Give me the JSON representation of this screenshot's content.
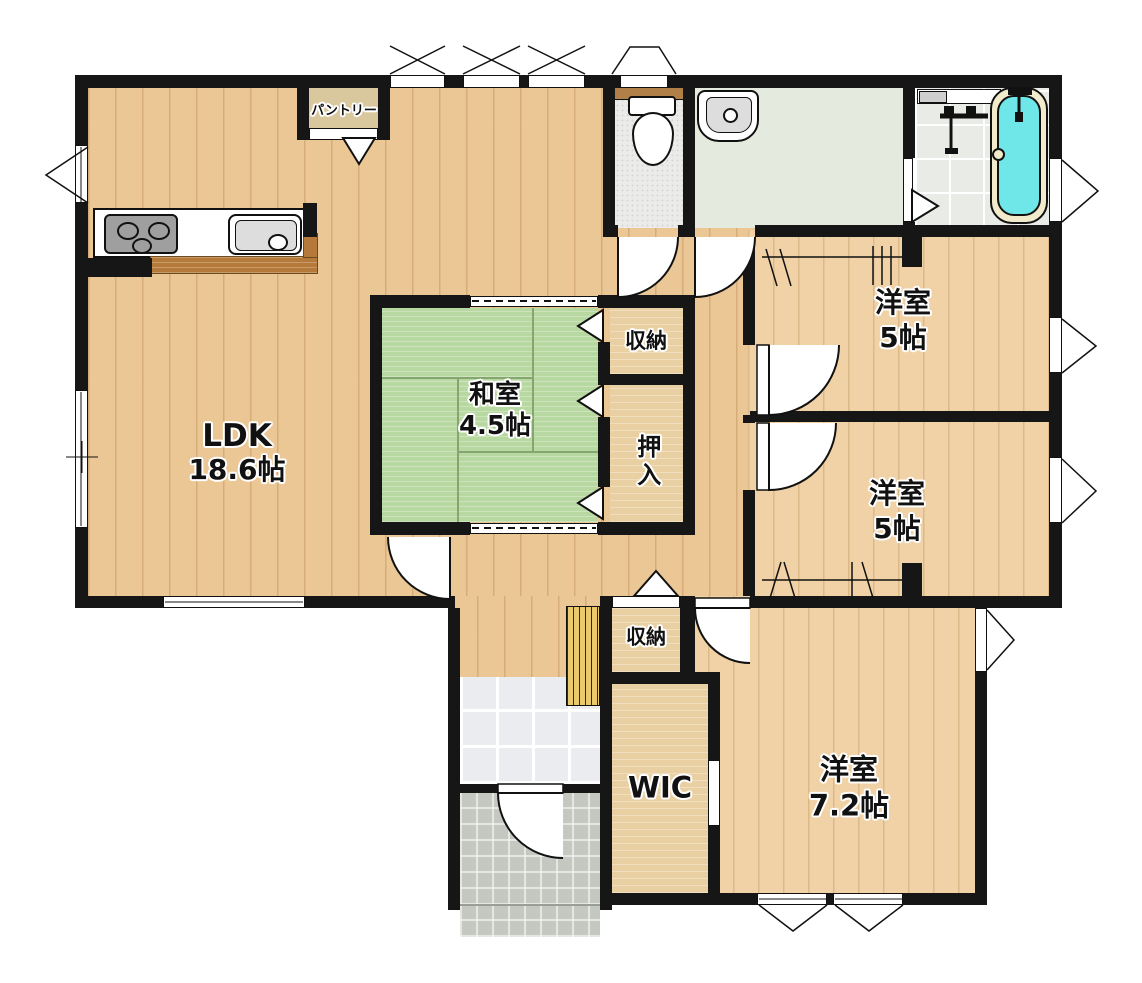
{
  "title": "floor-plan",
  "rooms": {
    "ldk": {
      "name": "LDK",
      "size": "18.6帖"
    },
    "washitsu": {
      "name": "和室",
      "size": "4.5帖"
    },
    "western_top": {
      "name": "洋室",
      "size": "5帖"
    },
    "western_mid": {
      "name": "洋室",
      "size": "5帖"
    },
    "western_7_2": {
      "name": "洋室",
      "size": "7.2帖"
    },
    "wic": {
      "name": "WIC"
    },
    "oshiire": {
      "name": "押入"
    },
    "storage_upper": {
      "name": "収納"
    },
    "storage_hall": {
      "name": "収納"
    },
    "pantry": {
      "name": "パントリー"
    }
  },
  "fixtures": {
    "stove": "gas-stove-3-burners",
    "sink": "kitchen-sink",
    "counter": "kitchen-counter",
    "toilet": "toilet",
    "washbasin": "washbasin",
    "bathtub": "bathtub",
    "shower": "shower-mixer",
    "shoe_rack": "shoe-cabinet-slats",
    "front_door": "entrance-door",
    "genkan": "entrance-tile",
    "porch": "porch-tile"
  },
  "colors": {
    "wall": "#161616",
    "wood_hall": "#ebc795",
    "wood_room": "#f0d2a6",
    "closet": "#e9d0a2",
    "pantry": "#d9c89e",
    "tatami": "#b8d8a2",
    "tatami_line": "#86a671",
    "toilet_floor": "#ebebe9",
    "washroom_floor": "#e5eade",
    "bath_floor": "#e9ebe6",
    "water": "#6fe7e9",
    "tub_rim": "#f1ebcc",
    "genkan_tile": "#eaecef",
    "porch_tile": "#c4c8c1",
    "counter_wood": "#b5793a",
    "shelf_brown": "#b08048",
    "fixture_gray": "#9f9f9f",
    "basin_gray": "#dddddd",
    "slats": "#e9c96b"
  }
}
